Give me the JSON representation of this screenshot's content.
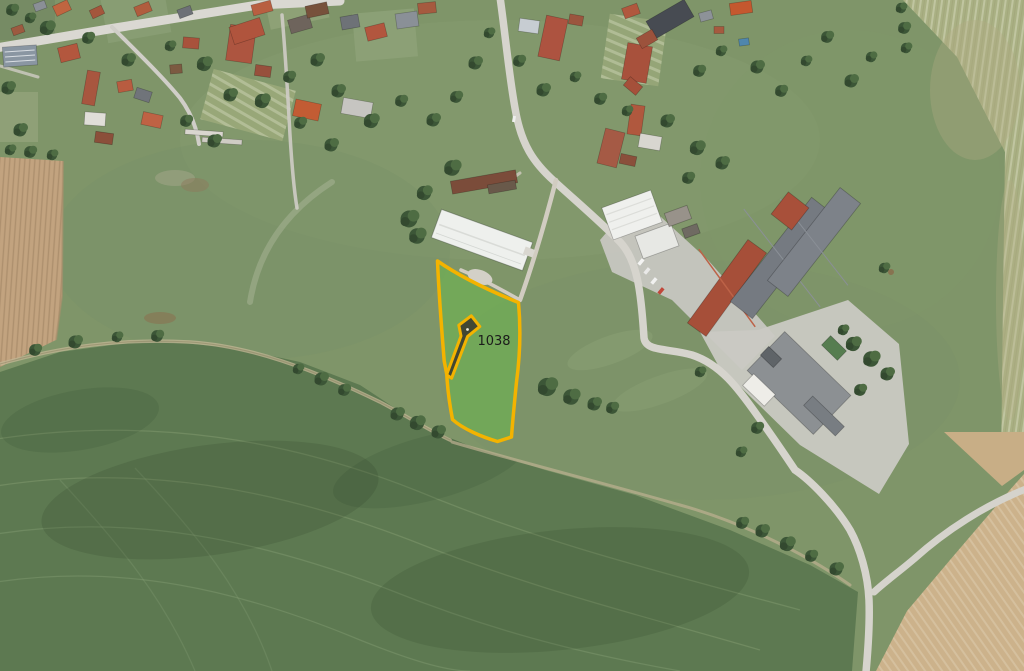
{
  "map": {
    "view": "aerial-orthophoto-with-cadastral-overlay",
    "parcel": {
      "label": "1038",
      "label_color": "#1b1b1b",
      "outline_color": "#f3b300",
      "fill_color": "rgba(100,196,66,0.42)"
    },
    "scene_colors": {
      "meadow": "#7f9569",
      "dark_field": "#5d7951",
      "tan_field_top_left": "#c2a37f",
      "tan_field_bottom_right": "#ccb28b",
      "pale_strip_field": "#a9b083",
      "road": "#dad8d2",
      "farm_yard": "#c7c6c1",
      "roof_red": "#ad5540",
      "roof_orange": "#c4582f",
      "roof_gray": "#757a81",
      "roof_white": "#eff0ed",
      "tree": "#3c5637"
    }
  }
}
